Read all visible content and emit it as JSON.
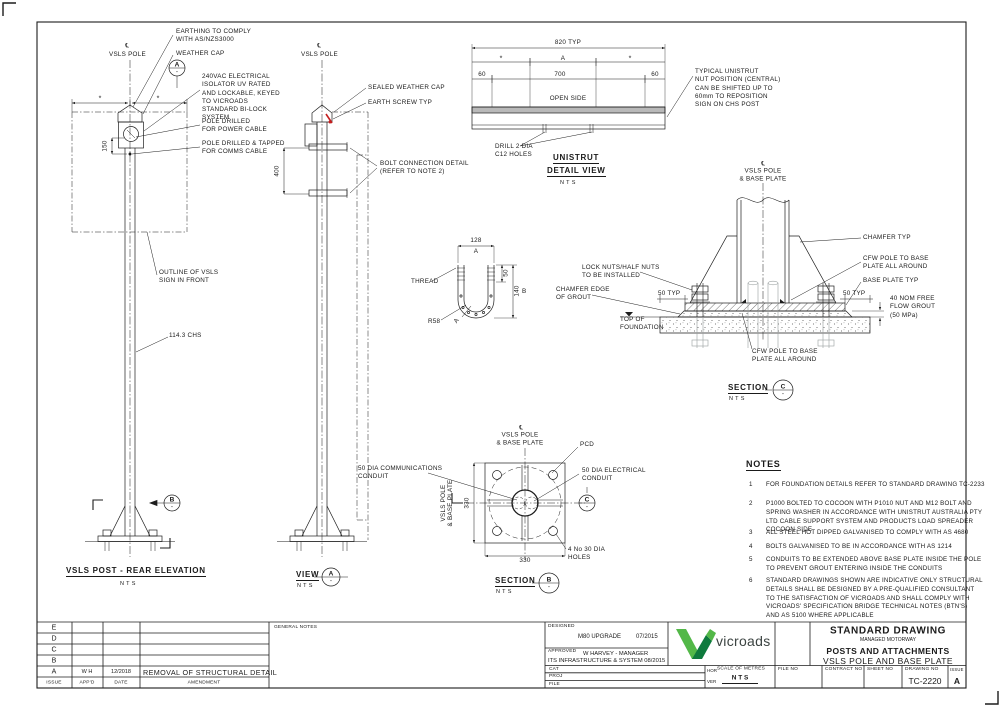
{
  "colors": {
    "line": "#1d1d1d",
    "ghost": "#9aa0a0",
    "red_mark": "#c41e1e",
    "logo_green_light": "#53b848",
    "logo_green_dark": "#0e7a3d",
    "logo_text_color": "#3c4442",
    "unistrut_fill": "#b9b9b9"
  },
  "rear": {
    "cl": "℄",
    "pole": "VSLS POLE",
    "star": "*",
    "earthing": "EARTHING TO COMPLY\nWITH AS/NZS3000",
    "weather_cap": "WEATHER CAP",
    "detail_a": "A",
    "detail_dash": "-",
    "isolator": "240VAC ELECTRICAL\nISOLATOR UV RATED\nAND LOCKABLE, KEYED\nTO VICROADS\nSTANDARD BI-LOCK\nSYSTEM",
    "power": "POLE DRILLED\nFOR POWER CABLE",
    "comms": "POLE DRILLED & TAPPED\nFOR COMMS CABLE",
    "dim150": "150",
    "outline": "OUTLINE OF VSLS\nSIGN IN FRONT",
    "chs": "114.3 CHS",
    "marker_b": "B",
    "marker_dash": "-",
    "title": "VSLS POST - REAR ELEVATION",
    "nts": "NTS"
  },
  "view_a": {
    "cl": "℄",
    "pole": "VSLS POLE",
    "sealed_cap": "SEALED WEATHER CAP",
    "earth_screw": "EARTH SCREW TYP",
    "bolt_conn": "BOLT CONNECTION DETAIL\n(REFER TO NOTE 2)",
    "dim400": "400",
    "title": "VIEW",
    "marker": "A",
    "marker_dash": "-",
    "nts": "NTS"
  },
  "unistrut": {
    "dim820": "820 TYP",
    "star": "*",
    "zone_a": "A",
    "dim60": "60",
    "dim700": "700",
    "open_side": "OPEN SIDE",
    "drill": "DRILL 2 DIA\nC12 HOLES",
    "nut_pos": "TYPICAL UNISTRUT\nNUT POSITION (CENTRAL)\nCAN BE SHIFTED UP TO\n60mm TO REPOSITION\nSIGN ON CHS POST",
    "title1": "UNISTRUT",
    "title2": "DETAIL VIEW",
    "nts": "NTS"
  },
  "ubolt": {
    "dim128": "128",
    "ref_a": "A",
    "thread": "THREAD",
    "r58": "R58",
    "dim50": "50",
    "dim140": "140",
    "ref_b": "B"
  },
  "sec_c": {
    "cl": "℄",
    "pole_label": "VSLS POLE\n& BASE PLATE",
    "chamfer": "CHAMFER TYP",
    "cfw": "CFW POLE TO BASE\nPLATE ALL AROUND",
    "base_plate": "BASE PLATE TYP",
    "grout": "40 NOM FREE\nFLOW GROUT\n(50 MPa)",
    "dim50typ": "50 TYP",
    "lock_nuts": "LOCK NUTS/HALF NUTS\nTO BE INSTALLED",
    "chamfer_edge": "CHAMFER EDGE\nOF GROUT",
    "top_found": "TOP OF\nFOUNDATION",
    "title": "SECTION",
    "marker": "C",
    "marker_dash": "-",
    "nts": "NTS"
  },
  "sec_b": {
    "cl": "℄",
    "pole_label": "VSLS POLE\n& BASE PLATE",
    "pcd": "PCD",
    "comms": "50 DIA COMMUNICATIONS\nCONDUIT",
    "elec": "50 DIA ELECTRICAL\nCONDUIT",
    "dim330": "330",
    "holes": "4 No 30 DIA\nHOLES",
    "title": "SECTION",
    "marker": "B",
    "marker_dash": "-",
    "view_marker": "C",
    "view_marker_dash": "-",
    "nts": "NTS"
  },
  "notes": {
    "title": "NOTES",
    "items": [
      {
        "n": "1",
        "text": "FOR FOUNDATION DETAILS REFER TO STANDARD DRAWING TC-2233"
      },
      {
        "n": "2",
        "text": "P1000 BOLTED TO COCOON WITH P1010 NUT AND M12 BOLT AND\nSPRING WASHER IN ACCORDANCE WITH UNISTRUT AUSTRALIA PTY\nLTD CABLE SUPPORT SYSTEM AND PRODUCTS LOAD SPREADER\nCOCOON SIDE"
      },
      {
        "n": "3",
        "text": "ALL STEEL HOT DIPPED GALVANISED TO COMPLY WITH AS 4680"
      },
      {
        "n": "4",
        "text": "BOLTS GALVANISED TO BE IN ACCORDANCE WITH AS 1214"
      },
      {
        "n": "5",
        "text": "CONDUITS TO BE EXTENDED ABOVE BASE PLATE INSIDE THE POLE\nTO PREVENT GROUT ENTERING INSIDE THE CONDUITS"
      },
      {
        "n": "6",
        "text": "STANDARD DRAWINGS SHOWN ARE INDICATIVE ONLY STRUCTURAL\nDETAILS SHALL BE DESIGNED BY A PRE-QUALIFIED CONSULTANT\nTO THE SATISFACTION OF VICROADS AND SHALL COMPLY WITH\nVICROADS' SPECIFICATION BRIDGE TECHNICAL NOTES (BTN'S)\nAND AS 5100 WHERE APPLICABLE"
      }
    ]
  },
  "title_block": {
    "letters": [
      "E",
      "D",
      "C",
      "B",
      "A"
    ],
    "appd_a": "W H",
    "date_a": "12/2018",
    "amendment_a": "REMOVAL OF STRUCTURAL DETAIL",
    "h_issue": "ISSUE",
    "h_appd": "APP'D",
    "h_date": "DATE",
    "h_amendment": "AMENDMENT",
    "general_notes": "GENERAL NOTES",
    "designed_label": "DESIGNED",
    "designed_value": "M80 UPGRADE",
    "designed_date": "07/2015",
    "approved_label": "APPROVED",
    "approved_value": "W HARVEY - MANAGER",
    "approved_line2": "ITS INFRASTRUCTURE & SYSTEM 08/2015",
    "cat": "CAT",
    "proj": "PROJ",
    "file": "FILE",
    "logo_text": "vicroads",
    "scale_label": "SCALE OF METRES",
    "hor": "HOR",
    "ver": "VER",
    "scale_value": "N T S",
    "file_no": "FILE NO",
    "contract_no": "CONTRACT NO",
    "sheet_no": "SHEET NO",
    "drawing_no_label": "DRAWING NO",
    "drawing_no": "TC-2220",
    "issue_label": "ISSUE",
    "issue_value": "A",
    "std_drawing": "STANDARD DRAWING",
    "managed": "MANAGED MOTORWAY",
    "series_title": "POSTS AND ATTACHMENTS",
    "sheet_title": "VSLS POLE AND BASE PLATE"
  }
}
